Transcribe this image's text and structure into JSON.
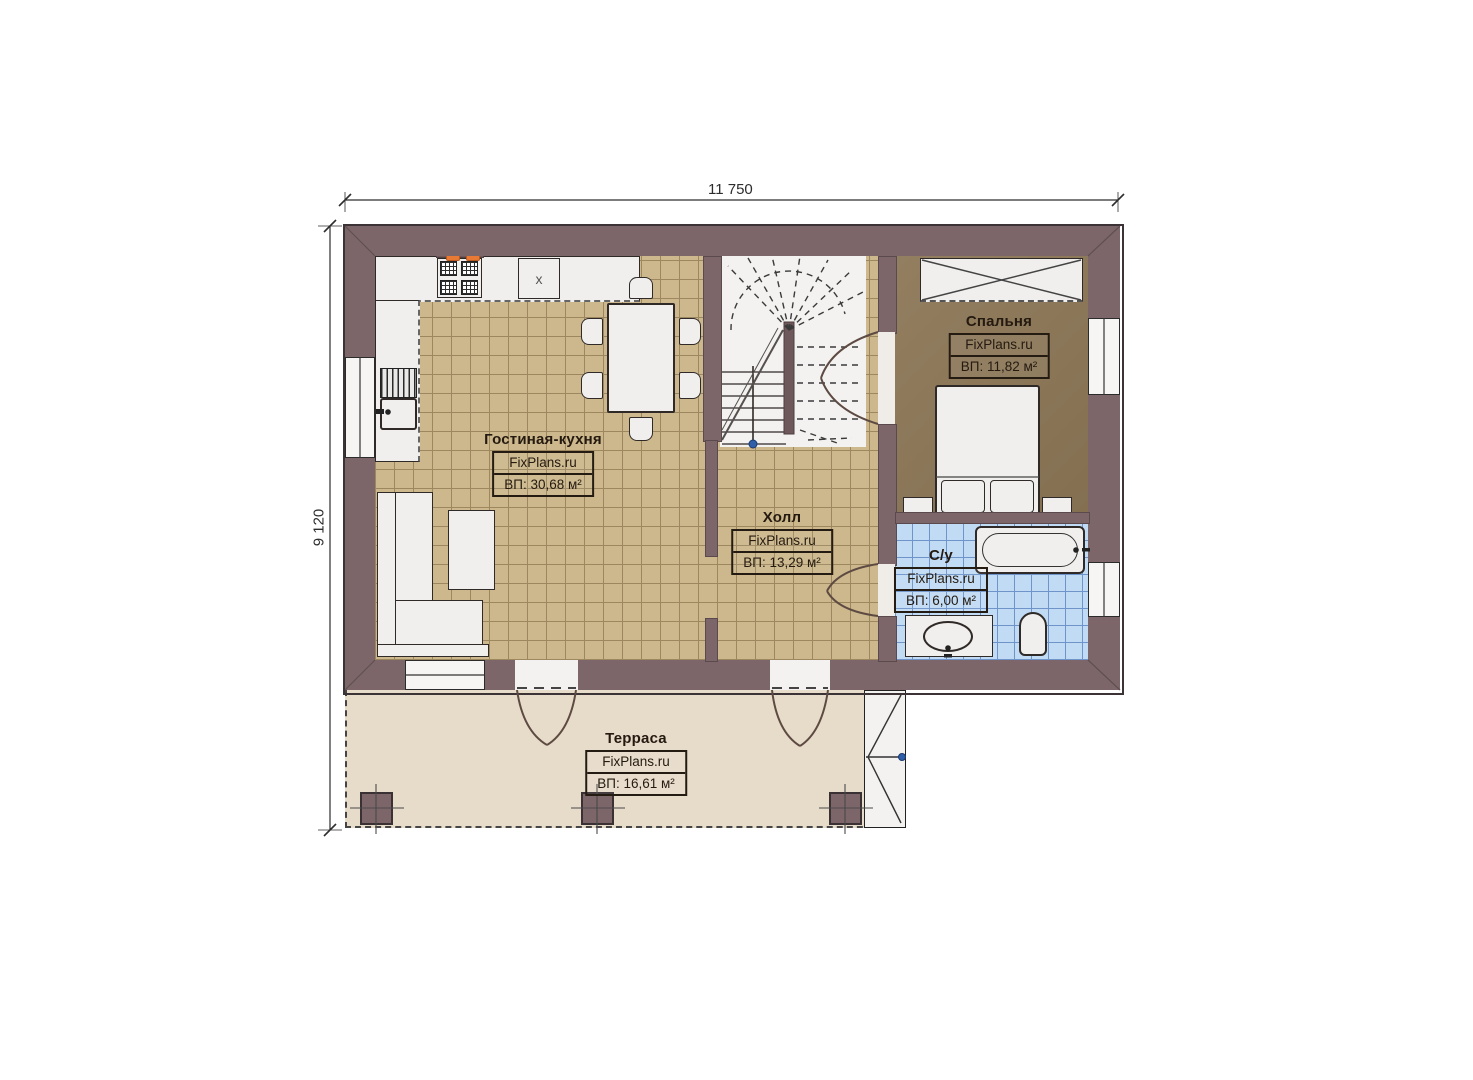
{
  "title": "FixPlans.ru план 1 этажа",
  "dimensions": {
    "width_label": "11 750",
    "height_label": "9 120"
  },
  "rooms": [
    {
      "name": "Гостиная-кухня",
      "brand": "FixPlans.ru",
      "area": "ВП: 30,68 м²"
    },
    {
      "name": "Холл",
      "brand": "FixPlans.ru",
      "area": "ВП: 13,29 м²"
    },
    {
      "name": "Спальня",
      "brand": "FixPlans.ru",
      "area": "ВП: 11,82 м²"
    },
    {
      "name": "С/у",
      "brand": "FixPlans.ru",
      "area": "ВП: 6,00 м²"
    },
    {
      "name": "Терраса",
      "brand": "FixPlans.ru",
      "area": "ВП: 16,61 м²"
    }
  ],
  "kitchen": {
    "cabinet_mark": "x"
  },
  "colors": {
    "wall": "#7d6669",
    "wall_outline": "#3c3336",
    "floor_tile": "#cdb78c",
    "floor_grid": "#9c875f",
    "bedroom_floor": "#8c7656",
    "bath_tile": "#c1dbf5",
    "bath_grid": "#6e94c9",
    "terrace_floor": "#e7dbc9",
    "furniture": "#f0efed",
    "line_dark": "#2f2a28",
    "accent_orange": "#e87a35",
    "marker_blue": "#2f5fa8"
  }
}
